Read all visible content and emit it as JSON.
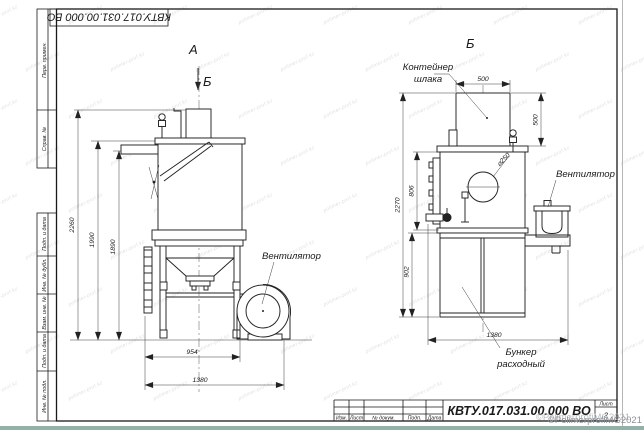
{
  "frame": {
    "designation_rotated": "КВТУ.017.031.00.000 ВО",
    "strip_top": [
      "Перв. примен.",
      "Справ. №"
    ],
    "strip_bottom": [
      "Подп. и дата",
      "Инв. № дубл.",
      "Взам. инв. №",
      "Подп. и дата",
      "Инв. № подл."
    ]
  },
  "views": {
    "left": {
      "label": "А",
      "arrow_label": "Б",
      "fan_label": "Вентилятор",
      "dims": {
        "h_total": "2260",
        "h_body": "1990",
        "h_pipe": "1890",
        "w_stand": "954",
        "w_total": "1380"
      }
    },
    "right": {
      "label": "Б",
      "container_label_1": "Контейнер",
      "container_label_2": "шлака",
      "fan_label": "Вентилятор",
      "bunker_label_1": "Бункер",
      "bunker_label_2": "расходный",
      "dims": {
        "cont_w": "500",
        "cont_h": "500",
        "body_h": "806",
        "total_h": "2270",
        "bunker_h": "902",
        "w_total": "1380",
        "hole": "⌀250"
      }
    }
  },
  "title_block": {
    "designation": "КВТУ.017.031.00.000 ВО",
    "col_labels": [
      "Изм.",
      "Лист",
      "№ докум.",
      "Подп.",
      "Дата"
    ],
    "sheet_label": "Лист",
    "sheet_value": "2"
  },
  "watermark": {
    "tile": "polimer-prof.kz",
    "copyright": "©PolimerprofiMG2021"
  }
}
